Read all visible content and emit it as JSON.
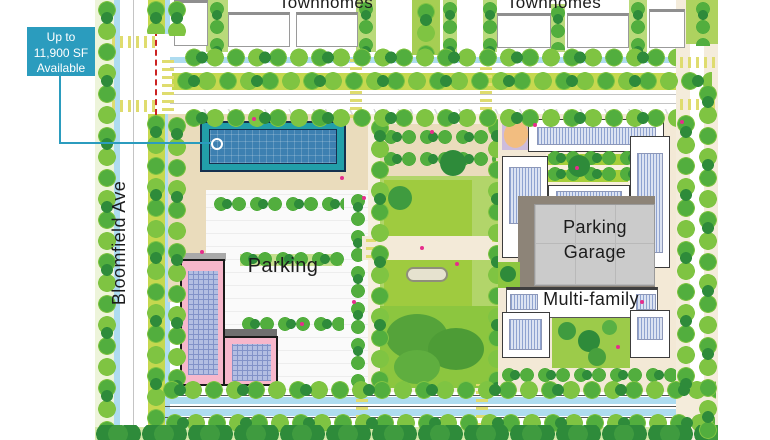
{
  "callout": {
    "line1": "Up to",
    "line2": "11,900 SF",
    "line3": "Available"
  },
  "streets": {
    "bloomfield": "Bloomfield Ave"
  },
  "labels": {
    "townhomes_west": "Townhomes",
    "townhomes_east": "Townhomes",
    "parking": "Parking",
    "parking_garage_line1": "Parking",
    "parking_garage_line2": "Garage",
    "multi_family": "Multi-family"
  },
  "colors": {
    "accent": "#2B9CBE",
    "teal_frame": "#229FA9",
    "teal_fill": "#3D80B1",
    "navy": "#16304E",
    "pink": "#F7B7CB",
    "grid_blue": "#B3BEE2",
    "grid_line": "#8292C8",
    "hatch_bg": "#DCE3F2",
    "hatch_line": "#8FA3D0",
    "garage": "#CBCBCB",
    "garage_shadow": "#8D8478",
    "lane_blue": "#AEDCF0",
    "median": "#C5D84F",
    "lawn": "#B9DA7A",
    "sand": "#EADCBC",
    "park_lawn": "#9FCB3F",
    "park_lawn2": "#B2D56A",
    "garden": "#8CC63F",
    "tree_dark": "#2E8B3A",
    "tree_mid": "#52AE3E",
    "tree_light": "#7FC442",
    "sidewalk": "#F4ECDB",
    "crosswalk": "#DFDC6E",
    "magenta": "#E62D8C",
    "bottom_strip": "#D3E9A8",
    "label_color": "#1C1C1C"
  }
}
